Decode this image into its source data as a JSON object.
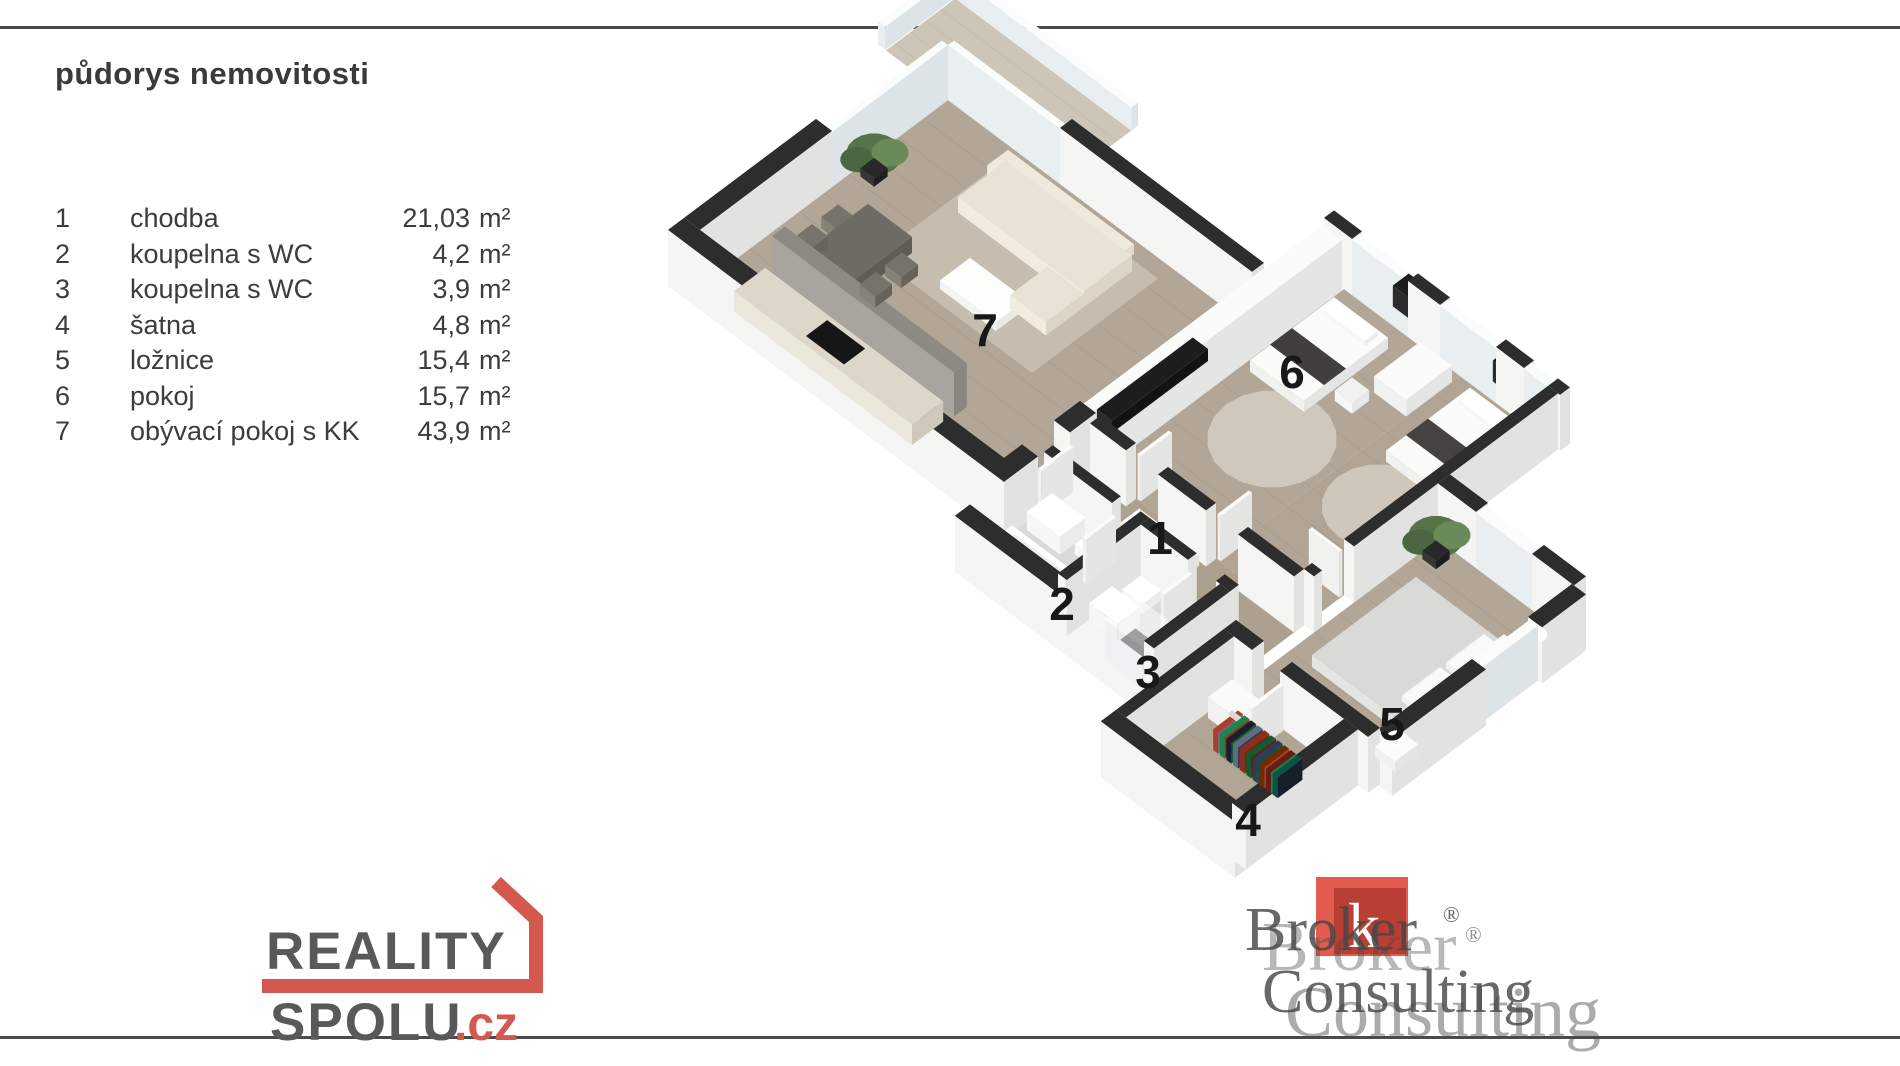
{
  "page": {
    "title": "půdorys nemovitosti"
  },
  "legend": {
    "unit": "m²",
    "rows": [
      {
        "num": "1",
        "name": "chodba",
        "area": "21,03"
      },
      {
        "num": "2",
        "name": "koupelna s WC",
        "area": "4,2"
      },
      {
        "num": "3",
        "name": "koupelna s WC",
        "area": "3,9"
      },
      {
        "num": "4",
        "name": "šatna",
        "area": "4,8"
      },
      {
        "num": "5",
        "name": "ložnice",
        "area": "15,4"
      },
      {
        "num": "6",
        "name": "pokoj",
        "area": "15,7"
      },
      {
        "num": "7",
        "name": "obývací pokoj s KK",
        "area": "43,9"
      }
    ]
  },
  "floorplan": {
    "labels": [
      {
        "text": "1",
        "x": 1160,
        "y": 538
      },
      {
        "text": "2",
        "x": 1062,
        "y": 604
      },
      {
        "text": "3",
        "x": 1148,
        "y": 672
      },
      {
        "text": "4",
        "x": 1248,
        "y": 820
      },
      {
        "text": "5",
        "x": 1392,
        "y": 724
      },
      {
        "text": "6",
        "x": 1292,
        "y": 372
      },
      {
        "text": "7",
        "x": 985,
        "y": 330
      }
    ],
    "colors": {
      "wall_top": "#2d2d2d",
      "wall_side": "#f5f5f3",
      "wood_floor": "#b2a797",
      "tile_floor": "#dadad6"
    }
  },
  "logos": {
    "reality_spolu": {
      "line1": "REALITY",
      "line2": "SPOLU",
      "suffix": ".cz",
      "accent": "#d4584e",
      "text_color": "#59595b"
    },
    "broker_consulting": {
      "word1": "Broker",
      "word2": "Consulting",
      "reg": "®",
      "square_letter": "k",
      "square_color": "#de4a3c",
      "text_color": "#474747"
    }
  }
}
